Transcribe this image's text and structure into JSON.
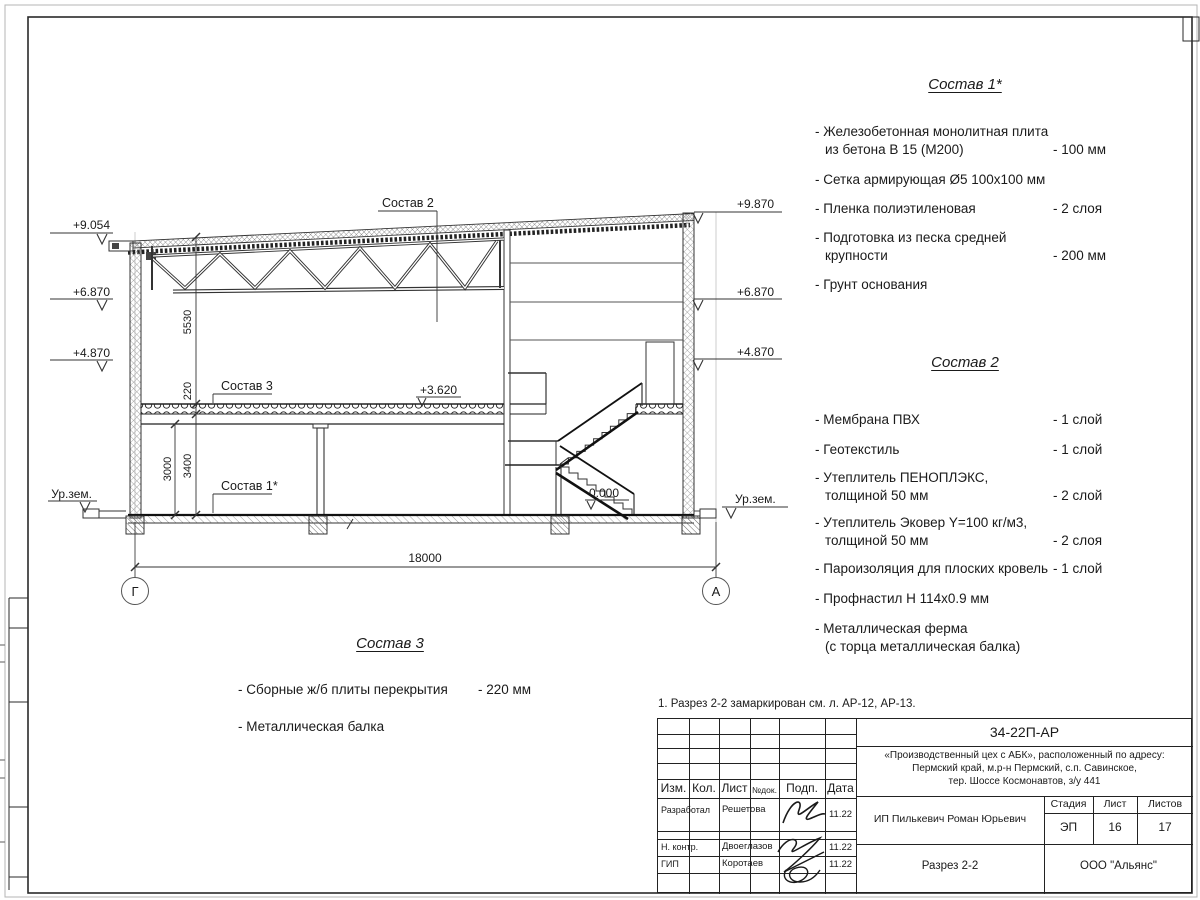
{
  "note": "1. Разрез 2-2 замаркирован см. л. АР-12, АР-13.",
  "compositions": {
    "c1": {
      "title": "Состав 1*",
      "items": [
        {
          "l1": "- Железобетонная  монолитная плита",
          "l2": "из бетона В 15 (М200)",
          "qty": "- 100 мм"
        },
        {
          "l1": "- Сетка армирующая Ø5 100х100 мм",
          "l2": "",
          "qty": ""
        },
        {
          "l1": "- Пленка полиэтиленовая",
          "l2": "",
          "qty": "-  2 слоя"
        },
        {
          "l1": "- Подготовка из песка средней",
          "l2": "крупности",
          "qty": "- 200 мм"
        },
        {
          "l1": "- Грунт основания",
          "l2": "",
          "qty": ""
        }
      ]
    },
    "c2": {
      "title": "Состав 2",
      "items": [
        {
          "l1": "- Мембрана ПВХ",
          "l2": "",
          "qty": "- 1 слой"
        },
        {
          "l1": "- Геотекстиль",
          "l2": "",
          "qty": "- 1 слой"
        },
        {
          "l1": "- Утеплитель ПЕНОПЛЭКС,",
          "l2": "толщиной 50 мм",
          "qty": "- 2 слой"
        },
        {
          "l1": "- Утеплитель Эковер Y=100 кг/м3,",
          "l2": "толщиной 50 мм",
          "qty": "- 2 слоя"
        },
        {
          "l1": "- Пароизоляция для плоских кровель",
          "l2": "",
          "qty": "- 1 слой"
        },
        {
          "l1": "- Профнастил Н 114х0.9 мм",
          "l2": "",
          "qty": ""
        },
        {
          "l1": "- Металлическая ферма",
          "l2": "(с торца металлическая балка)",
          "qty": ""
        }
      ]
    },
    "c3": {
      "title": "Состав 3",
      "items": [
        {
          "l1": "- Сборные ж/б  плиты перекрытия",
          "l2": "",
          "qty": "- 220 мм"
        },
        {
          "l1": "- Металлическая балка",
          "l2": "",
          "qty": ""
        }
      ]
    }
  },
  "drawing": {
    "marks_left": {
      "m1": "+9.054",
      "m2": "+6.870",
      "m3": "+4.870",
      "m4": "Ур.зем."
    },
    "marks_right": {
      "m1": "+9.870",
      "m2": "+6.870",
      "m3": "+4.870",
      "m4": "Ур.зем."
    },
    "levels": {
      "upper": "+3.620",
      "zero": "0.000"
    },
    "labels": {
      "s1": "Состав 1*",
      "s2": "Состав 2",
      "s3": "Состав 3"
    },
    "dims": {
      "truss_h": "5530",
      "slab": "220",
      "story_a": "3400",
      "story_b": "3000",
      "span": "18000"
    },
    "axes": {
      "left": "Г",
      "right": "А"
    }
  },
  "title_block": {
    "code": "34-22П-АР",
    "project": {
      "l1": "«Производственный цех с АБК», расположенный по адресу:",
      "l2": "Пермский край, м.р-н Пермский, с.п. Савинское,",
      "l3": "тер. Шоссе Космонавтов, з/у 441"
    },
    "cols": {
      "izm": "Изм.",
      "kol": "Кол.",
      "list": "Лист",
      "ndok": "№док.",
      "podp": "Подп.",
      "data": "Дата"
    },
    "rows": {
      "r1": {
        "role": "Разработал",
        "name": "Решетова",
        "date": "11.22"
      },
      "r2": {
        "role": "Н. контр.",
        "name": "Двоеглазов",
        "date": "11.22"
      },
      "r3": {
        "role": "ГИП",
        "name": "Коротаев",
        "date": "11.22"
      }
    },
    "client": "ИП Пилькевич Роман Юрьевич",
    "stage": {
      "label": "Стадия",
      "value": "ЭП"
    },
    "sheet": {
      "label": "Лист",
      "value": "16"
    },
    "sheets": {
      "label": "Листов",
      "value": "17"
    },
    "title": "Разрез 2-2",
    "company": "ООО \"Альянс\""
  }
}
